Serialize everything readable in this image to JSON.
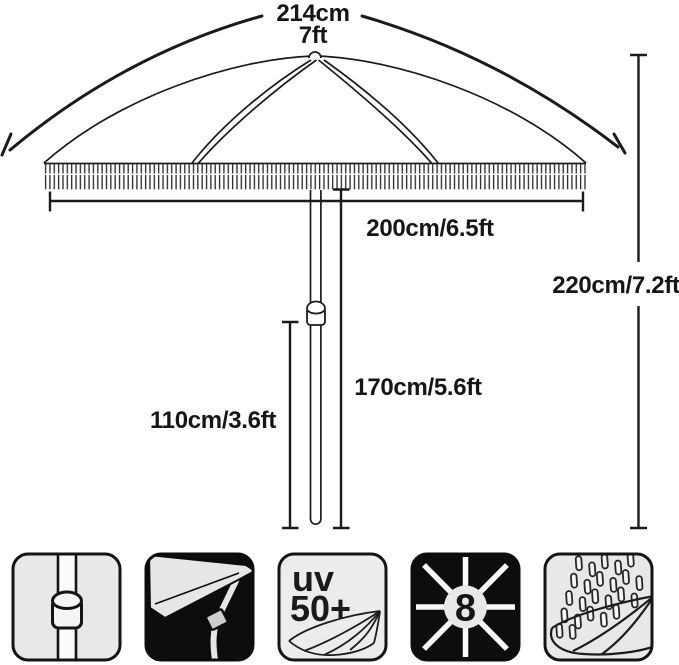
{
  "diagram": {
    "labels": {
      "arc_cm": "214cm",
      "arc_ft": "7ft",
      "canopy_width": "200cm/6.5ft",
      "upper_pole_height": "170cm/5.6ft",
      "lower_pole_height": "110cm/3.6ft",
      "total_height": "220cm/7.2ft"
    }
  },
  "features": {
    "uv_badge": {
      "line1": "uv",
      "line2": "50+"
    },
    "ribs_count": "8",
    "icons": [
      {
        "name": "pole-joint-icon"
      },
      {
        "name": "tilt-umbrella-icon"
      },
      {
        "name": "uv-50-protection-icon"
      },
      {
        "name": "eight-ribs-icon"
      },
      {
        "name": "fringe-rain-icon"
      }
    ]
  },
  "colors": {
    "ink": "#1b1b1b",
    "icon_bg": "#e9e8e6",
    "icon_dark": "#0d0d0d",
    "background": "#ffffff"
  }
}
